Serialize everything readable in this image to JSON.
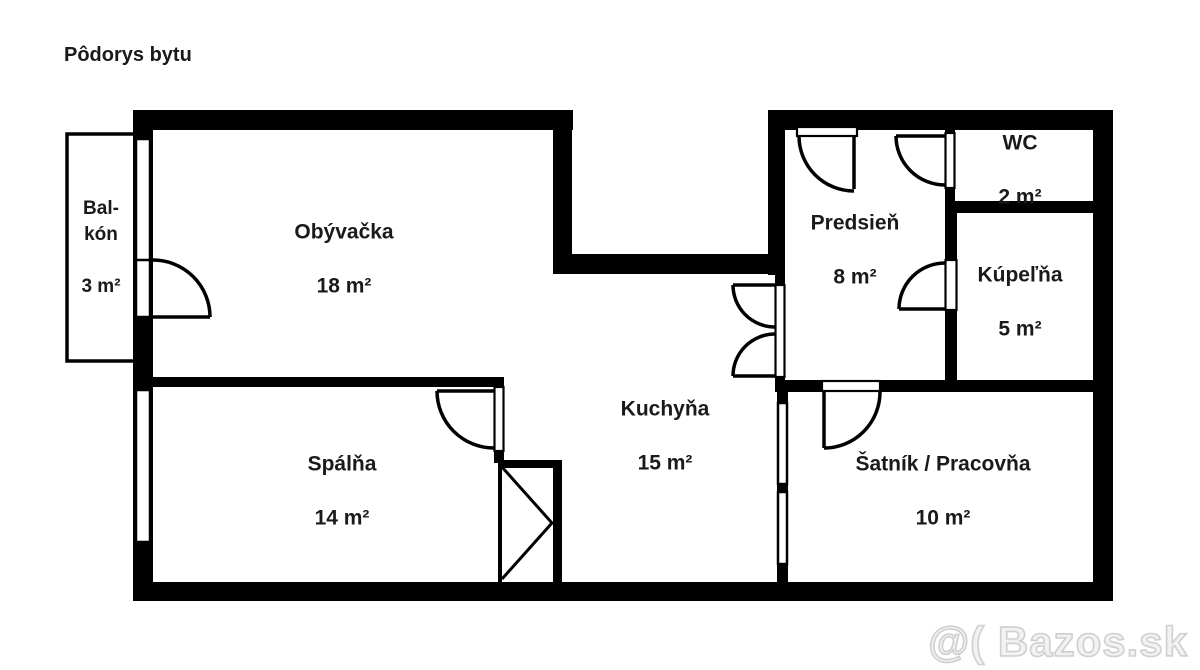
{
  "page": {
    "title": "Pôdorys bytu",
    "background_color": "#ffffff",
    "wall_color": "#000000",
    "watermark_color": "#cfcfcf"
  },
  "rooms": [
    {
      "id": "balkon",
      "name": "Bal-\nkón",
      "area": "3 m²"
    },
    {
      "id": "obyvacka",
      "name": "Obývačka",
      "area": "18 m²"
    },
    {
      "id": "spalna",
      "name": "Spálňa",
      "area": "14 m²"
    },
    {
      "id": "kuchyna",
      "name": "Kuchyňa",
      "area": "15 m²"
    },
    {
      "id": "predsien",
      "name": "Predsieň",
      "area": "8 m²"
    },
    {
      "id": "wc",
      "name": "WC",
      "area": "2 m²"
    },
    {
      "id": "kupelna",
      "name": "Kúpeľňa",
      "area": "5 m²"
    },
    {
      "id": "satnik",
      "name": "Šatník / Pracovňa",
      "area": "10 m²"
    }
  ],
  "watermark": {
    "text": "@( Bazos.sk"
  }
}
